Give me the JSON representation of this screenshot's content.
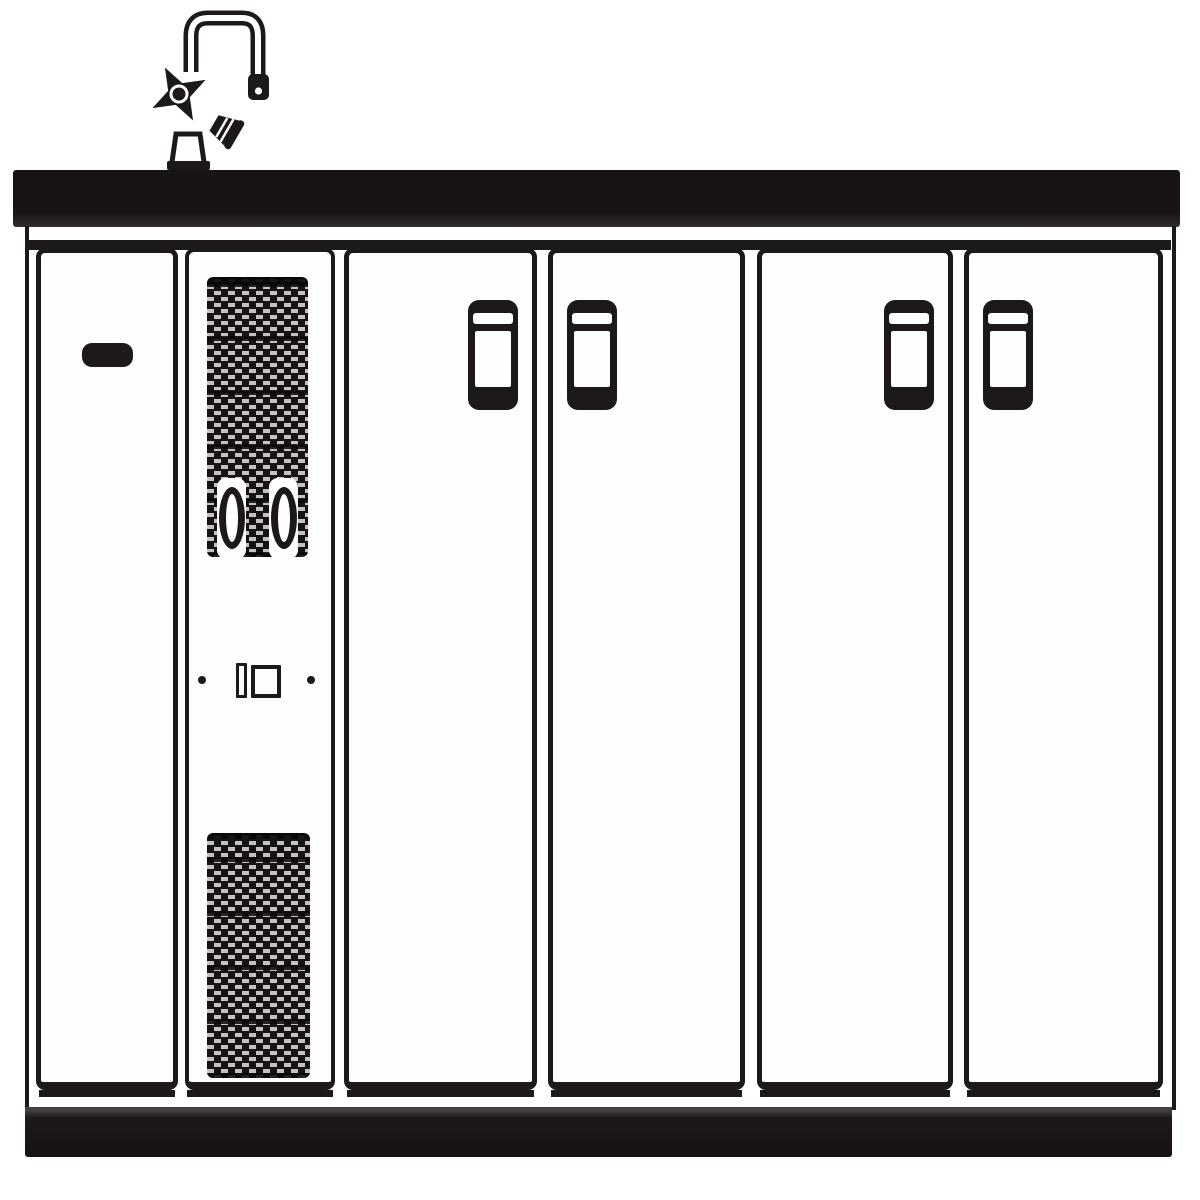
{
  "diagram": {
    "kind": "technical line drawing",
    "subject": "kitchen sink base cabinet unit, front elevation",
    "colors": {
      "ink": "#1d1919",
      "background": "#ffffff",
      "panel_fill": "#fefefe",
      "grille_dash": "#c6c1c1"
    },
    "parts": {
      "faucet": {
        "label": "two-handle kitchen faucet with high-arc spout"
      },
      "countertop": {
        "label": "countertop / worktop slab"
      },
      "frame": {
        "label": "cabinet carcass frame"
      },
      "door1": {
        "label": "left service door with horizontal pull handle"
      },
      "vent": {
        "label": "ventilation panel with louvre grilles, two rotary knobs, switch and indicator dots"
      },
      "grille_top": {
        "label": "upper louvre grille"
      },
      "grille_bottom": {
        "label": "lower louvre grille"
      },
      "knob_left": {
        "label": "left rotary control knob"
      },
      "knob_right": {
        "label": "right rotary control knob"
      },
      "indicator_left": {
        "label": "left indicator dot"
      },
      "indicator_right": {
        "label": "right indicator dot"
      },
      "switch_small": {
        "label": "rocker switch"
      },
      "switch_big": {
        "label": "main switch window"
      },
      "door2": {
        "label": "cabinet door with vertical handle (handle at right edge)"
      },
      "door3": {
        "label": "cabinet door with vertical handle (handle at left edge)"
      },
      "door4": {
        "label": "cabinet door with vertical handle (handle at right edge)"
      },
      "door5": {
        "label": "cabinet door with vertical handle (handle at left edge)"
      },
      "plinth": {
        "label": "kick plate / plinth"
      }
    }
  }
}
